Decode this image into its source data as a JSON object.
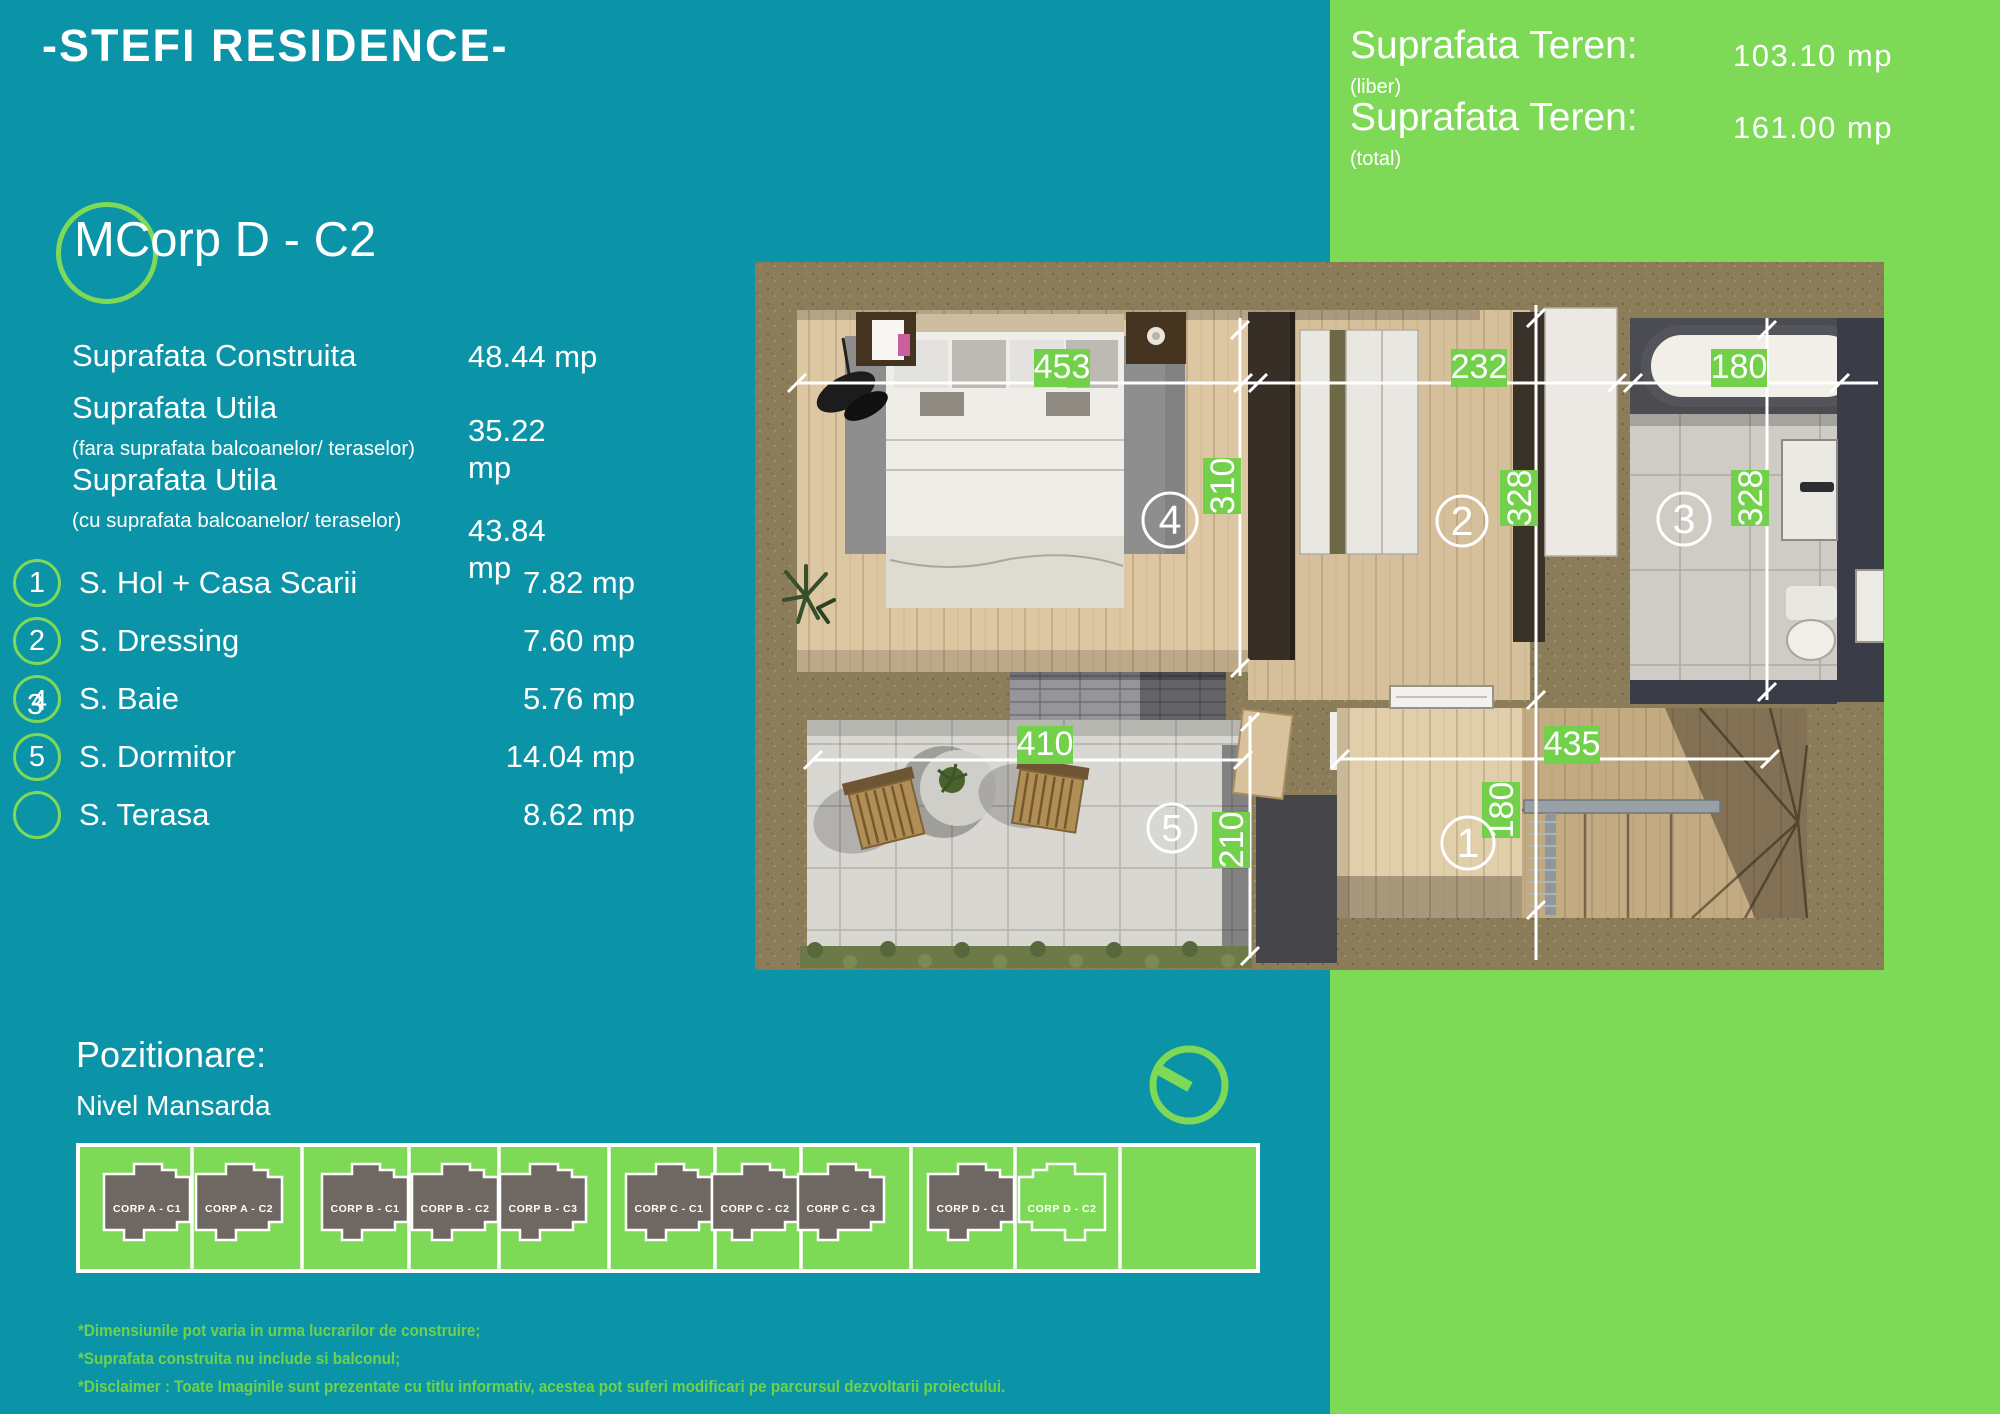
{
  "colors": {
    "teal_background": "#0b93a8",
    "green_panel": "#7ed957",
    "dim_label_green": "#72d04a",
    "building_gray": "#6f6862",
    "disclaimer_green": "#70d24a"
  },
  "header": {
    "brand": "-STEFI RESIDENCE-"
  },
  "land": {
    "rows": [
      {
        "label": "Suprafata Teren:",
        "value": "103.10 mp",
        "note": "(liber)"
      },
      {
        "label": "Suprafata Teren:",
        "value": "161.00 mp",
        "note": "(total)"
      }
    ]
  },
  "unit": {
    "logo_letter": "M",
    "title": "Corp D - C2"
  },
  "specs": [
    {
      "label": "Suprafata Construita",
      "value_main": "48.44",
      "value_unit": "mp"
    },
    {
      "label": "Suprafata Utila",
      "note": "(fara suprafata balcoanelor/ teraselor)",
      "value_main": "35.22",
      "value_unit": "mp"
    },
    {
      "label": "Suprafata Utila",
      "note": "(cu suprafata balcoanelor/ teraselor)",
      "value_main": "43.84",
      "value_unit": "mp"
    }
  ],
  "rooms": [
    {
      "num": "1",
      "label": "S. Hol + Casa Scarii",
      "value": "7.82 mp"
    },
    {
      "num": "2",
      "label": "S. Dressing",
      "value": "7.60 mp"
    },
    {
      "num": "3",
      "num_alt": "4",
      "label": "S. Baie",
      "value": "5.76 mp"
    },
    {
      "num": "5",
      "label": "S. Dormitor",
      "value": "14.04 mp"
    },
    {
      "num": "",
      "label": "S. Terasa",
      "value": "8.62 mp"
    }
  ],
  "plan": {
    "dims": {
      "top": [
        "453",
        "232",
        "180"
      ],
      "verticals": [
        "310",
        "328",
        "328"
      ],
      "bottom": [
        "410",
        "435"
      ],
      "bottom_verticals": [
        "210",
        "180"
      ]
    },
    "markers": {
      "dormitor": "4",
      "dressing": "2",
      "baie": "3",
      "terasa": "5",
      "hol": "1"
    }
  },
  "positioning": {
    "title": "Pozitionare:",
    "subtitle": "Nivel Mansarda",
    "plots": [
      {
        "label": "CORP A - C1",
        "highlight": false
      },
      {
        "label": "CORP A - C2",
        "highlight": false
      },
      {
        "label": "CORP B - C1",
        "highlight": false
      },
      {
        "label": "CORP B - C2",
        "highlight": false
      },
      {
        "label": "CORP B - C3",
        "highlight": false
      },
      {
        "label": "CORP C - C1",
        "highlight": false
      },
      {
        "label": "CORP C - C2",
        "highlight": false
      },
      {
        "label": "CORP C - C3",
        "highlight": false
      },
      {
        "label": "CORP D - C1",
        "highlight": false
      },
      {
        "label": "CORP D - C2",
        "highlight": true
      }
    ]
  },
  "icons": {
    "clock": "clock-dial-icon",
    "logo": "logo-ring-icon"
  },
  "disclaimer": [
    "*Dimensiunile pot varia in urma lucrarilor de construire;",
    "*Suprafata construita nu include si balconul;",
    "*Disclaimer : Toate Imaginile sunt prezentate cu titlu informativ, acestea pot suferi modificari pe parcursul dezvoltarii proiectului."
  ]
}
